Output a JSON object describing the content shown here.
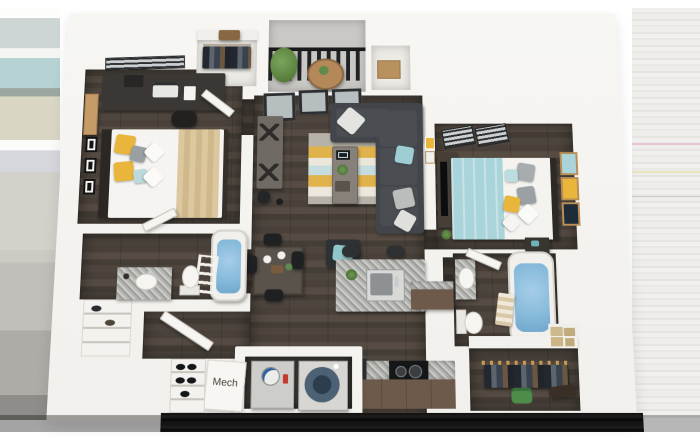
{
  "scene": {
    "description_label": "",
    "background": "#ffffff"
  },
  "labels": {
    "mech_room": "Mech"
  },
  "palette": {
    "wall_white": "#f6f5f2",
    "floor_wood": "#4e463e",
    "closet_floor": "#eceae5",
    "balcony_concrete": "#c9c8c4",
    "railing_dark": "#1d1f21",
    "rug_gray": "#b7b2a8",
    "rug_yellow": "#e0b24c",
    "rug_cream": "#ebe6da",
    "rug_blue": "#c6dde0",
    "sofa_charcoal": "#42464a",
    "accent_teal": "#a9d4da",
    "accent_yellow": "#e9b53a",
    "bed_linen_white": "#f5f4f1",
    "throw_tan": "#d8c39c",
    "granite_gray": "#b4b4b0",
    "cabinet_brown": "#6d5a4b",
    "tub_water_blue": "#85b9da",
    "appliance_gray": "#d6d5d2",
    "dryer_door_blue": "#4d6174",
    "plant_green": "#5f8b4a",
    "bottom_edge_band": "#121110",
    "edge_stripe_teal": "#b6d2d3",
    "edge_stripe_beige": "#d9d6c4",
    "edge_stripe_pink": "#eac3d4"
  },
  "rooms": [
    {
      "name": "bedroom-1",
      "furniture": [
        "window-blinds",
        "corkboard",
        "desk",
        "laptop",
        "printer",
        "desk-chair",
        "picture-frames",
        "queen-bed",
        "yellow-pillows",
        "tan-throw"
      ]
    },
    {
      "name": "walk-in-closet-1",
      "furniture": [
        "shelf",
        "suitcase",
        "hanging-clothes",
        "door"
      ]
    },
    {
      "name": "balcony",
      "furniture": [
        "railing",
        "potted-plant",
        "round-table"
      ]
    },
    {
      "name": "storage-closet",
      "furniture": [
        "cardboard-box"
      ]
    },
    {
      "name": "living-room",
      "furniture": [
        "window-wall",
        "area-rug",
        "coffee-table",
        "tablet",
        "sectional-sofa",
        "throw-pillows",
        "ottoman",
        "console-table",
        "speaker"
      ]
    },
    {
      "name": "dining-area",
      "furniture": [
        "dining-table",
        "chairs",
        "plates",
        "vase"
      ]
    },
    {
      "name": "kitchen",
      "furniture": [
        "island",
        "sink",
        "bar-stools",
        "plant",
        "refrigerator",
        "range",
        "granite-counter",
        "brown-cabinets"
      ]
    },
    {
      "name": "bedroom-2",
      "furniture": [
        "window-blinds",
        "dresser",
        "tv",
        "queen-bed",
        "teal-duvet",
        "nightstand",
        "wall-art-frames",
        "plant"
      ]
    },
    {
      "name": "bathroom-1",
      "furniture": [
        "bathtub",
        "towel-ladder",
        "toilet",
        "vanity-sink",
        "door"
      ]
    },
    {
      "name": "bathroom-2",
      "furniture": [
        "vanity-sink",
        "toilet",
        "bathtub",
        "rolled-towels",
        "folded-towels",
        "door"
      ]
    },
    {
      "name": "closet-2",
      "furniture": [
        "shelf-boxes",
        "hanger-rod",
        "hanging-clothes",
        "green-bag"
      ]
    },
    {
      "name": "mech-room",
      "label": "Mech",
      "furniture": [
        "water-heater",
        "dryer",
        "door"
      ]
    },
    {
      "name": "entry",
      "furniture": [
        "entry-door",
        "shoe-shelf",
        "linen-closet"
      ]
    }
  ]
}
